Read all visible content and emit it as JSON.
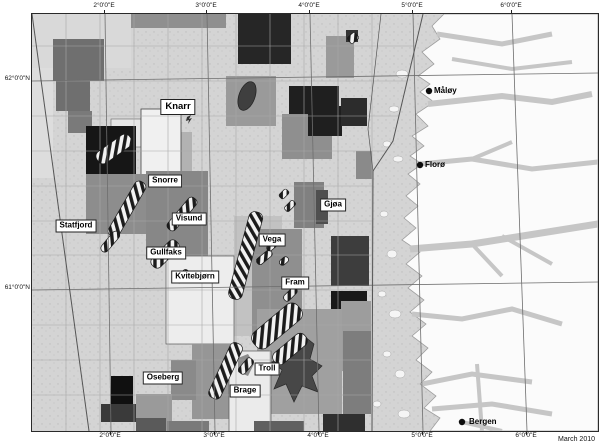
{
  "map": {
    "date_note": "March 2010",
    "axis": {
      "top": [
        "2°0'0\"E",
        "3°0'0\"E",
        "4°0'0\"E",
        "5°0'0\"E",
        "6°0'0\"E"
      ],
      "bottom": [
        "2°0'0\"E",
        "3°0'0\"E",
        "4°0'0\"E",
        "5°0'0\"E",
        "6°0'0\"E"
      ],
      "left": [
        "62°0'0\"N",
        "61°0'0\"N"
      ],
      "right": [
        "62°0'0\"N",
        "61°0'0\"N"
      ]
    },
    "fields": [
      {
        "name": "Knarr"
      },
      {
        "name": "Snorre"
      },
      {
        "name": "Statfjord"
      },
      {
        "name": "Visund"
      },
      {
        "name": "Gullfaks"
      },
      {
        "name": "Kvitebjørn"
      },
      {
        "name": "Vega"
      },
      {
        "name": "Fram"
      },
      {
        "name": "Gjøa"
      },
      {
        "name": "Troll"
      },
      {
        "name": "Oseberg"
      },
      {
        "name": "Brage"
      }
    ],
    "cities": [
      {
        "name": "Måløy"
      },
      {
        "name": "Florø"
      },
      {
        "name": "Bergen"
      }
    ],
    "colors": {
      "sea": "#d4d4d4",
      "land": "#fbfbfb",
      "fjord": "#c6c6c6",
      "block_light": "#dedede",
      "block_medium": "#8f8f8f",
      "block_dark": "#4a4a4a",
      "block_black": "#1a1a1a",
      "label_box": "#ffffff",
      "line": "#555555"
    }
  }
}
